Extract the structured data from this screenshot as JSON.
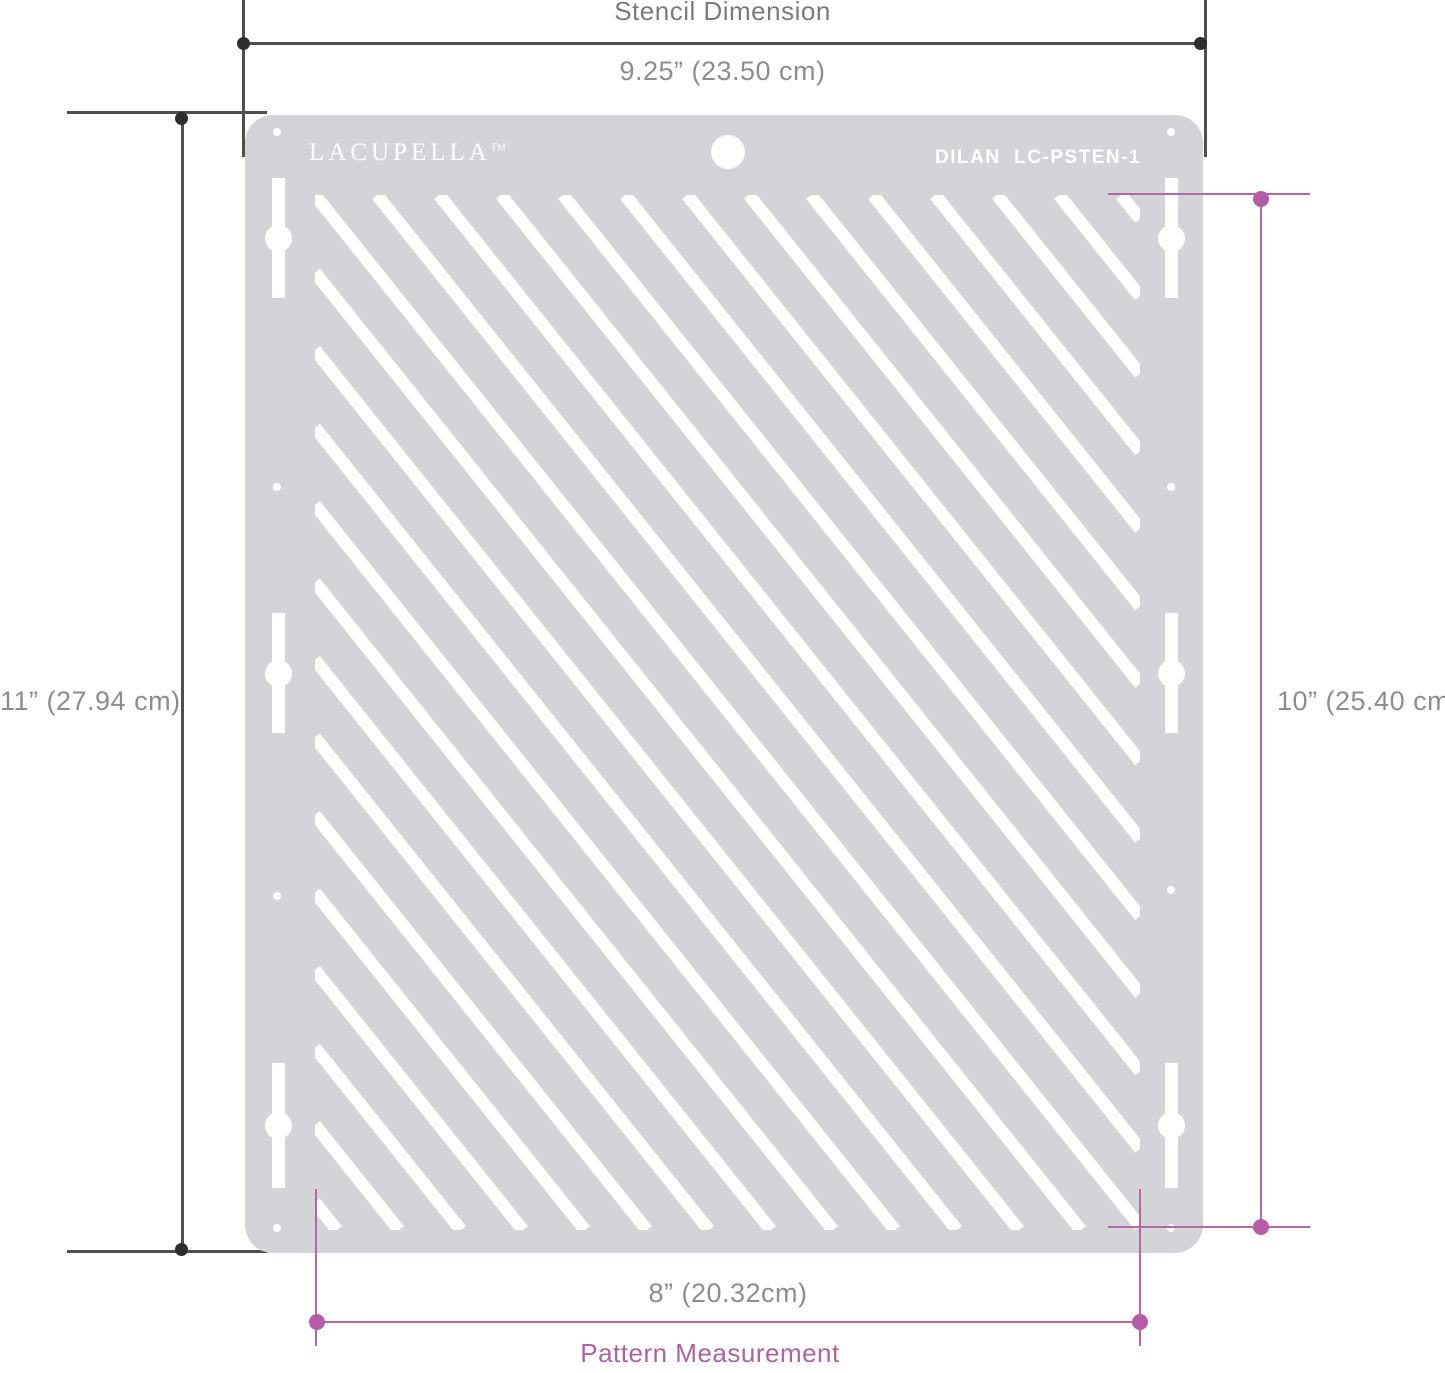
{
  "colors": {
    "stencil_gray": "#d2d4d7",
    "cutout_white": "#ffffff",
    "dim_dark_line": "#4f4f4f",
    "dim_dark_dot": "#2e2e2e",
    "dim_gray_text": "#8d8d8d",
    "dim_title_text": "#7b7b7b",
    "pink_line": "#b268a3",
    "pink_dot": "#b85ba6",
    "pink_text": "#ad639e"
  },
  "top_dimension": {
    "title": "Stencil Dimension",
    "value": "9.25” (23.50 cm)"
  },
  "left_dimension": {
    "value": "11” (27.94 cm)"
  },
  "right_dimension": {
    "value": "10” (25.40 cm)"
  },
  "bottom_dimension": {
    "value": "8” (20.32cm)",
    "label": "Pattern Measurement"
  },
  "stencil": {
    "brand": "LACUPELLA",
    "brand_tm": "TM",
    "product_code": "DILAN  LC-PSTEN-1",
    "pattern": {
      "type": "diagonal-stripes",
      "direction": "top-left-to-bottom-right",
      "angle_deg": 51.34,
      "spacing_px": 62,
      "stripe_width_px": 12.5,
      "area_width_px": 825,
      "area_height_px": 1035,
      "k_min": -13,
      "k_max": 13
    }
  }
}
